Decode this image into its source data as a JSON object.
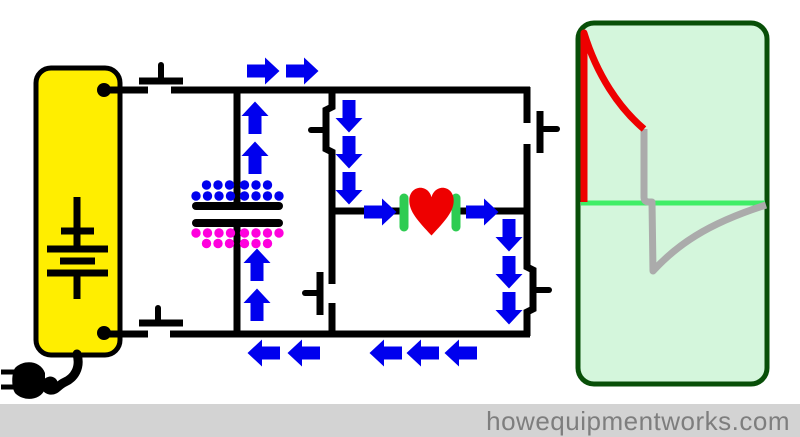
{
  "title": "Biphasic defibrillator circuit diagram",
  "footer": {
    "text": "howequipmentworks.com"
  },
  "colors": {
    "background": "#ffffff",
    "wire": "#000000",
    "arrow": "#0000ee",
    "negative_charge": "#0000ee",
    "positive_charge": "#ff00dd",
    "battery_fill": "#ffee00",
    "heart": "#ee0000",
    "electrode": "#2ecc52",
    "panel_fill": "#d4f6dc",
    "panel_border": "#084f08",
    "baseline": "#3fee66",
    "phase1_curve": "#ee0000",
    "phase2_curve": "#ababab",
    "footer_bg": "#d3d3d3",
    "footer_text": "#7e7e7e"
  },
  "circuit": {
    "power_source": {
      "type": "battery-with-mains-plug",
      "state": "disconnected"
    },
    "switches": [
      {
        "id": "charge-switch-top",
        "orientation": "horizontal",
        "state": "open"
      },
      {
        "id": "charge-switch-bottom",
        "orientation": "horizontal",
        "state": "open"
      },
      {
        "id": "bridge-switch-left-top",
        "orientation": "vertical",
        "state": "closed"
      },
      {
        "id": "bridge-switch-left-bottom",
        "orientation": "vertical",
        "state": "open"
      },
      {
        "id": "bridge-switch-right-top",
        "orientation": "vertical",
        "state": "open"
      },
      {
        "id": "bridge-switch-right-bottom",
        "orientation": "vertical",
        "state": "closed"
      }
    ],
    "capacitor": {
      "top_plate_charge": "negative",
      "bottom_plate_charge": "positive"
    },
    "load": {
      "type": "heart",
      "electrodes": 2
    }
  },
  "current_arrows": [
    {
      "x": 263,
      "y": 71,
      "dir": "right"
    },
    {
      "x": 302,
      "y": 71,
      "dir": "right"
    },
    {
      "x": 255,
      "y": 118,
      "dir": "up"
    },
    {
      "x": 255,
      "y": 158,
      "dir": "up"
    },
    {
      "x": 257,
      "y": 265,
      "dir": "up"
    },
    {
      "x": 257,
      "y": 305,
      "dir": "up"
    },
    {
      "x": 349,
      "y": 116,
      "dir": "down"
    },
    {
      "x": 349,
      "y": 152,
      "dir": "down"
    },
    {
      "x": 349,
      "y": 188,
      "dir": "down"
    },
    {
      "x": 380,
      "y": 212,
      "dir": "right"
    },
    {
      "x": 482,
      "y": 212,
      "dir": "right"
    },
    {
      "x": 509,
      "y": 235,
      "dir": "down"
    },
    {
      "x": 509,
      "y": 272,
      "dir": "down"
    },
    {
      "x": 509,
      "y": 308,
      "dir": "down"
    },
    {
      "x": 264,
      "y": 353,
      "dir": "left"
    },
    {
      "x": 304,
      "y": 353,
      "dir": "left"
    },
    {
      "x": 386,
      "y": 353,
      "dir": "left"
    },
    {
      "x": 423,
      "y": 353,
      "dir": "left"
    },
    {
      "x": 461,
      "y": 353,
      "dir": "left"
    }
  ],
  "charges": {
    "negative_dots": [
      [
        206.5,
        185
      ],
      [
        218,
        185
      ],
      [
        229.5,
        185
      ],
      [
        244.5,
        185
      ],
      [
        256,
        185
      ],
      [
        267.5,
        185
      ],
      [
        196,
        196
      ],
      [
        207.5,
        196
      ],
      [
        219,
        196
      ],
      [
        230.5,
        196
      ],
      [
        244.5,
        196
      ],
      [
        256,
        196
      ],
      [
        267.5,
        196
      ],
      [
        279,
        196
      ]
    ],
    "positive_dots": [
      [
        196,
        233
      ],
      [
        207.5,
        233
      ],
      [
        219,
        233
      ],
      [
        230.5,
        233
      ],
      [
        244.5,
        233
      ],
      [
        256,
        233
      ],
      [
        267.5,
        233
      ],
      [
        279,
        233
      ],
      [
        206.5,
        243.5
      ],
      [
        218,
        243.5
      ],
      [
        229.5,
        243.5
      ],
      [
        244.5,
        243.5
      ],
      [
        256,
        243.5
      ],
      [
        267.5,
        243.5
      ]
    ]
  },
  "waveform": {
    "description": "biphasic truncated exponential discharge",
    "baseline": {
      "x1": 581,
      "y": 203,
      "x2": 765
    },
    "phase1_path": "M584,202 L584,33 C597,75 619,108 644,129",
    "phase2_path": "M644,129 L644,197 Q644,202 649,202 L652,202 L653,271 C676,246 706,224 766,205"
  }
}
